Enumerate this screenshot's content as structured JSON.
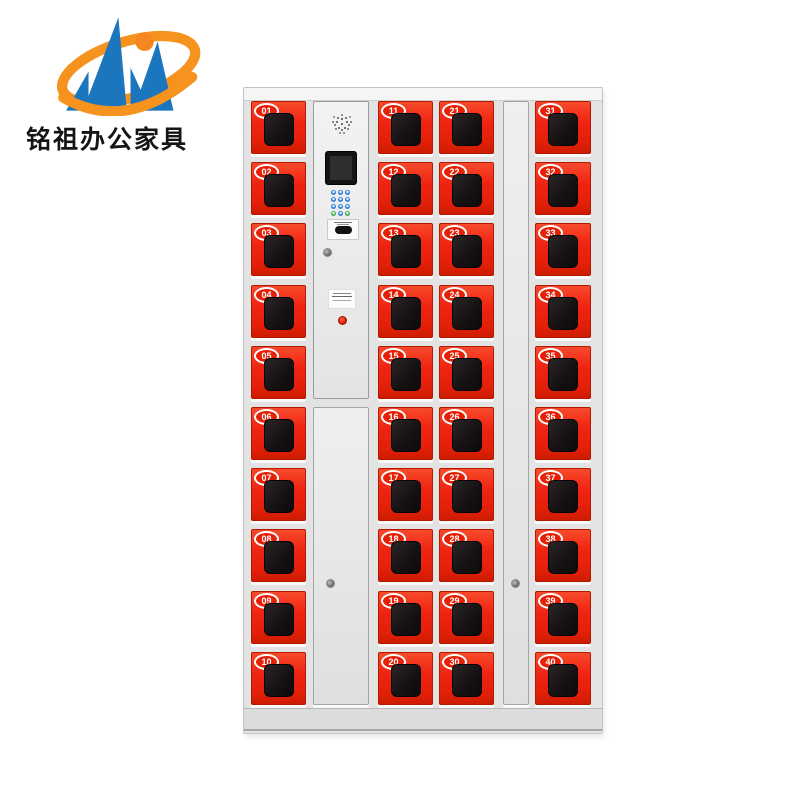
{
  "brand": {
    "name": "铭祖办公家具",
    "logo_blue": "#1b76bd",
    "logo_orange": "#f6921e"
  },
  "cabinet": {
    "type": "smart-phone-storage-locker",
    "door_color": "#ee2110",
    "frame_color": "#e3e3e3",
    "window_color": "#161213",
    "locker_columns": [
      {
        "position": "far-left",
        "numbers": [
          "01",
          "02",
          "03",
          "04",
          "05",
          "06",
          "07",
          "08",
          "09",
          "10"
        ]
      },
      {
        "position": "center-left",
        "numbers": [
          "11",
          "12",
          "13",
          "14",
          "15",
          "16",
          "17",
          "18",
          "19",
          "20"
        ]
      },
      {
        "position": "center-right",
        "numbers": [
          "21",
          "22",
          "23",
          "24",
          "25",
          "26",
          "27",
          "28",
          "29",
          "30"
        ]
      },
      {
        "position": "far-right",
        "numbers": [
          "31",
          "32",
          "33",
          "34",
          "35",
          "36",
          "37",
          "38",
          "39",
          "40"
        ]
      }
    ],
    "control": {
      "speaker": "speaker-grille-icon",
      "screen": "lcd-touchscreen",
      "keypad_rows": [
        [
          "blue",
          "blue",
          "blue"
        ],
        [
          "blue",
          "blue",
          "blue"
        ],
        [
          "blue",
          "blue",
          "blue"
        ],
        [
          "green",
          "blue",
          "green"
        ]
      ],
      "card_reader": "card-reader-slot",
      "indicator_color": "#e11c00"
    }
  }
}
